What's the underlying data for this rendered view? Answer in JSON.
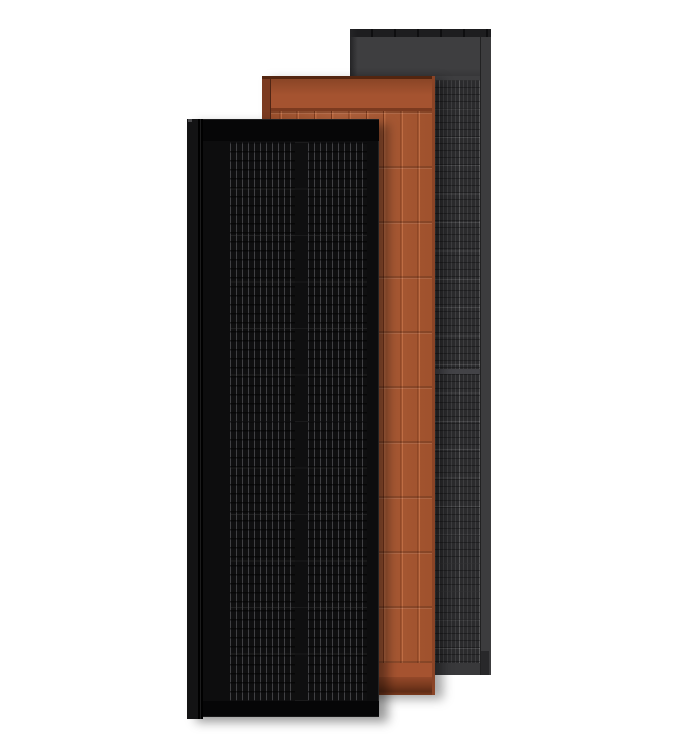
{
  "image": {
    "type": "product-render",
    "description": "Three tall rectangular building-integrated solar roof shingles overlapping left-to-right on a plain white background",
    "background": "#ffffff"
  },
  "panels": [
    {
      "name": "Matte black solar shingle",
      "position": "front",
      "surface": "black monocrystalline cell grid with thin vertical busbars in two column groups"
    },
    {
      "name": "Terracotta solar shingle",
      "position": "middle",
      "surface": "terracotta tile-textured face with vertical cell ridges and horizontal course lines"
    },
    {
      "name": "Slate gray solar shingle",
      "position": "back",
      "surface": "dark gray framed module with fine cell grid and center module divider"
    }
  ],
  "colors": {
    "bg": "#ffffff",
    "gray-top-strip": "#1d1d1f",
    "gray-header": "#3e3e40",
    "gray-left-edge": "#242426",
    "gray-cell-base": "#2b2b2d",
    "gray-divider": "#434347",
    "gray-frame": "#3c3c3e",
    "gray-bottom": "#39393b",
    "gray-notch": "#28282a",
    "orange-dark-line": "#53250f",
    "orange-header-top": "#8a4526",
    "orange-header": "#a55330",
    "orange-seam": "#7c3a1f",
    "orange-cell": "#a9562f",
    "orange-ridge": "#bf6d44",
    "orange-gap": "#7e3a1d",
    "orange-left": "#7b3a20",
    "orange-right": "#8a4426",
    "orange-bottom-top": "#94492a",
    "orange-bottom-mid": "#7a3a1e",
    "orange-bottom-deep": "#5f2c16",
    "black-header": "#060607",
    "black-surface": "#0d0d0e",
    "black-flange": "#131314",
    "black-cell": "#0f0f10",
    "black-busbar": "#414144",
    "black-glint": "#4a4a4c"
  }
}
